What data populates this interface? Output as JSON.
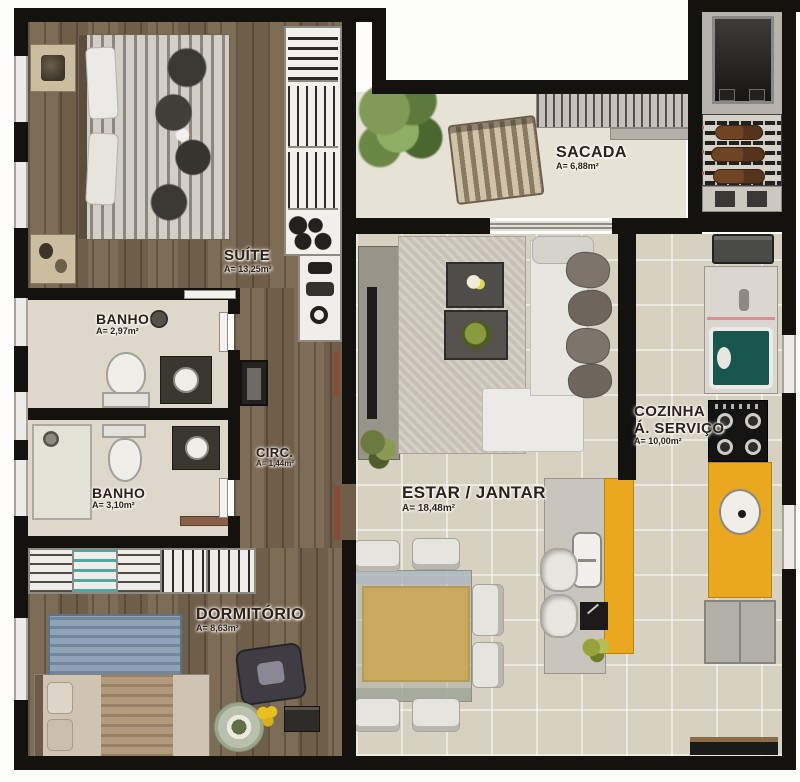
{
  "plan": {
    "type": "apartment-floor-plan",
    "rooms": {
      "suite": {
        "name": "SUÍTE",
        "area": "A= 13,25m²"
      },
      "banho_suite": {
        "name": "BANHO",
        "area": "A= 2,97m²"
      },
      "banho_social": {
        "name": "BANHO",
        "area": "A= 3,10m²"
      },
      "circulacao": {
        "name": "CIRC.",
        "area": "A= 1,44m²"
      },
      "dormitorio": {
        "name": "DORMITÓRIO",
        "area": "A= 8,63m²"
      },
      "estar_jantar": {
        "name": "ESTAR / JANTAR",
        "area": "A= 18,48m²"
      },
      "sacada": {
        "name": "SACADA",
        "area": "A= 6,88m²"
      },
      "cozinha_servico": {
        "name_line1": "COZINHA",
        "name_line2": "Á. SERVIÇO",
        "area": "A= 10,00m²"
      }
    },
    "colors": {
      "wall": "#14120f",
      "wood_floor": "#74634e",
      "tile_floor": "#d7d1c2",
      "bath_floor": "#ddd8ca",
      "balcony_floor": "#e7e2d6",
      "accent_yellow": "#e9a81f",
      "accent_teal": "#1c6158",
      "rug_blue": "#8fa3b5",
      "label_text": "#2d2217"
    }
  }
}
